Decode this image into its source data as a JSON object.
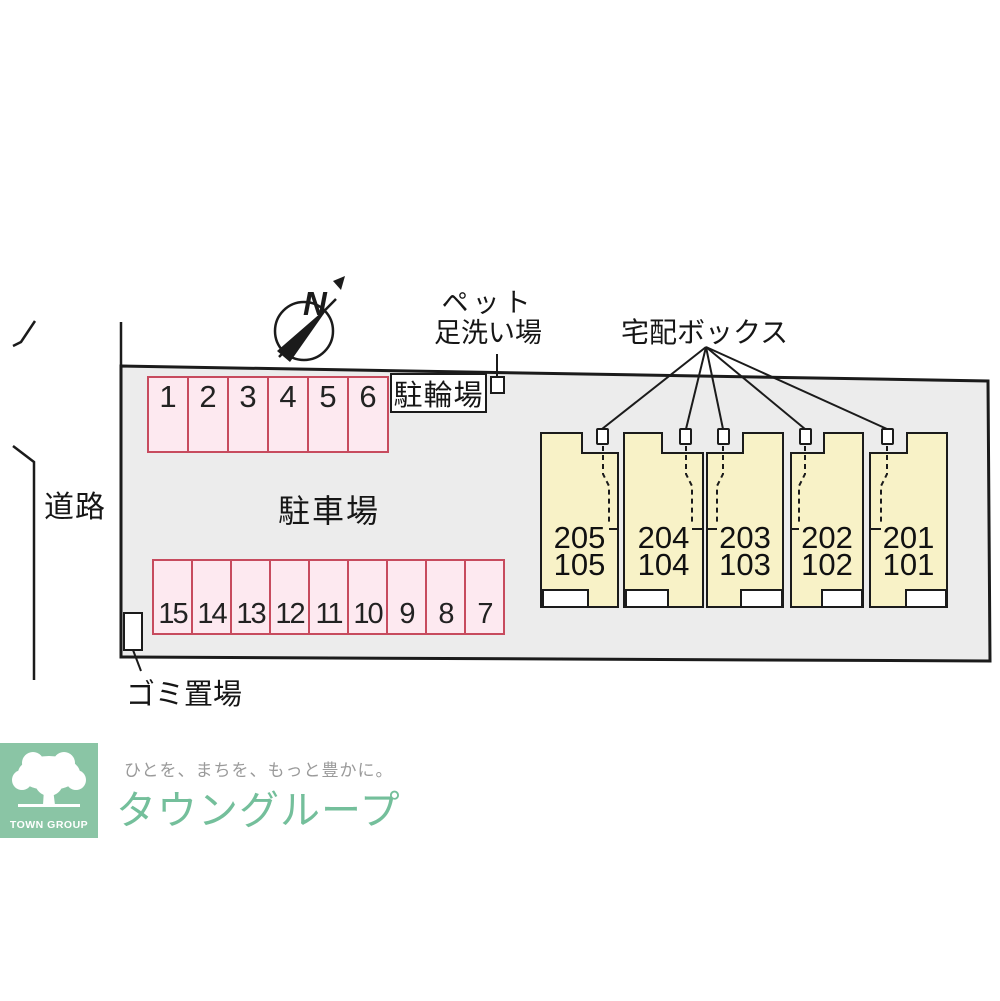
{
  "plan": {
    "north_label": "N",
    "road_label": "道路",
    "parking_area_label": "駐車場",
    "bicycle_parking_label": "駐輪場",
    "pet_wash_label_line1": "ペット",
    "pet_wash_label_line2": "足洗い場",
    "delivery_box_label": "宅配ボックス",
    "garbage_area_label": "ゴミ置場",
    "parking_spaces_top": [
      "1",
      "2",
      "3",
      "4",
      "5",
      "6"
    ],
    "parking_spaces_bottom": [
      "15",
      "14",
      "13",
      "12",
      "11",
      "10",
      "9",
      "8",
      "7"
    ],
    "units": [
      {
        "upper": "205",
        "lower": "105"
      },
      {
        "upper": "204",
        "lower": "104"
      },
      {
        "upper": "203",
        "lower": "103"
      },
      {
        "upper": "202",
        "lower": "102"
      },
      {
        "upper": "201",
        "lower": "101"
      }
    ]
  },
  "branding": {
    "logo_square_text": "TOWN GROUP",
    "tagline": "ひとを、まちを、もっと豊かに。",
    "company_name": "タウングループ"
  },
  "colors": {
    "site_fill": "#ececec",
    "unit_fill": "#f8f2c7",
    "parking_fill": "#fde9f0",
    "parking_border": "#c74b5e",
    "line_black": "#1b1b1b",
    "logo_green": "#8ac5a5",
    "brand_green": "#74bf9b",
    "tagline_gray": "#9a9a9a"
  }
}
